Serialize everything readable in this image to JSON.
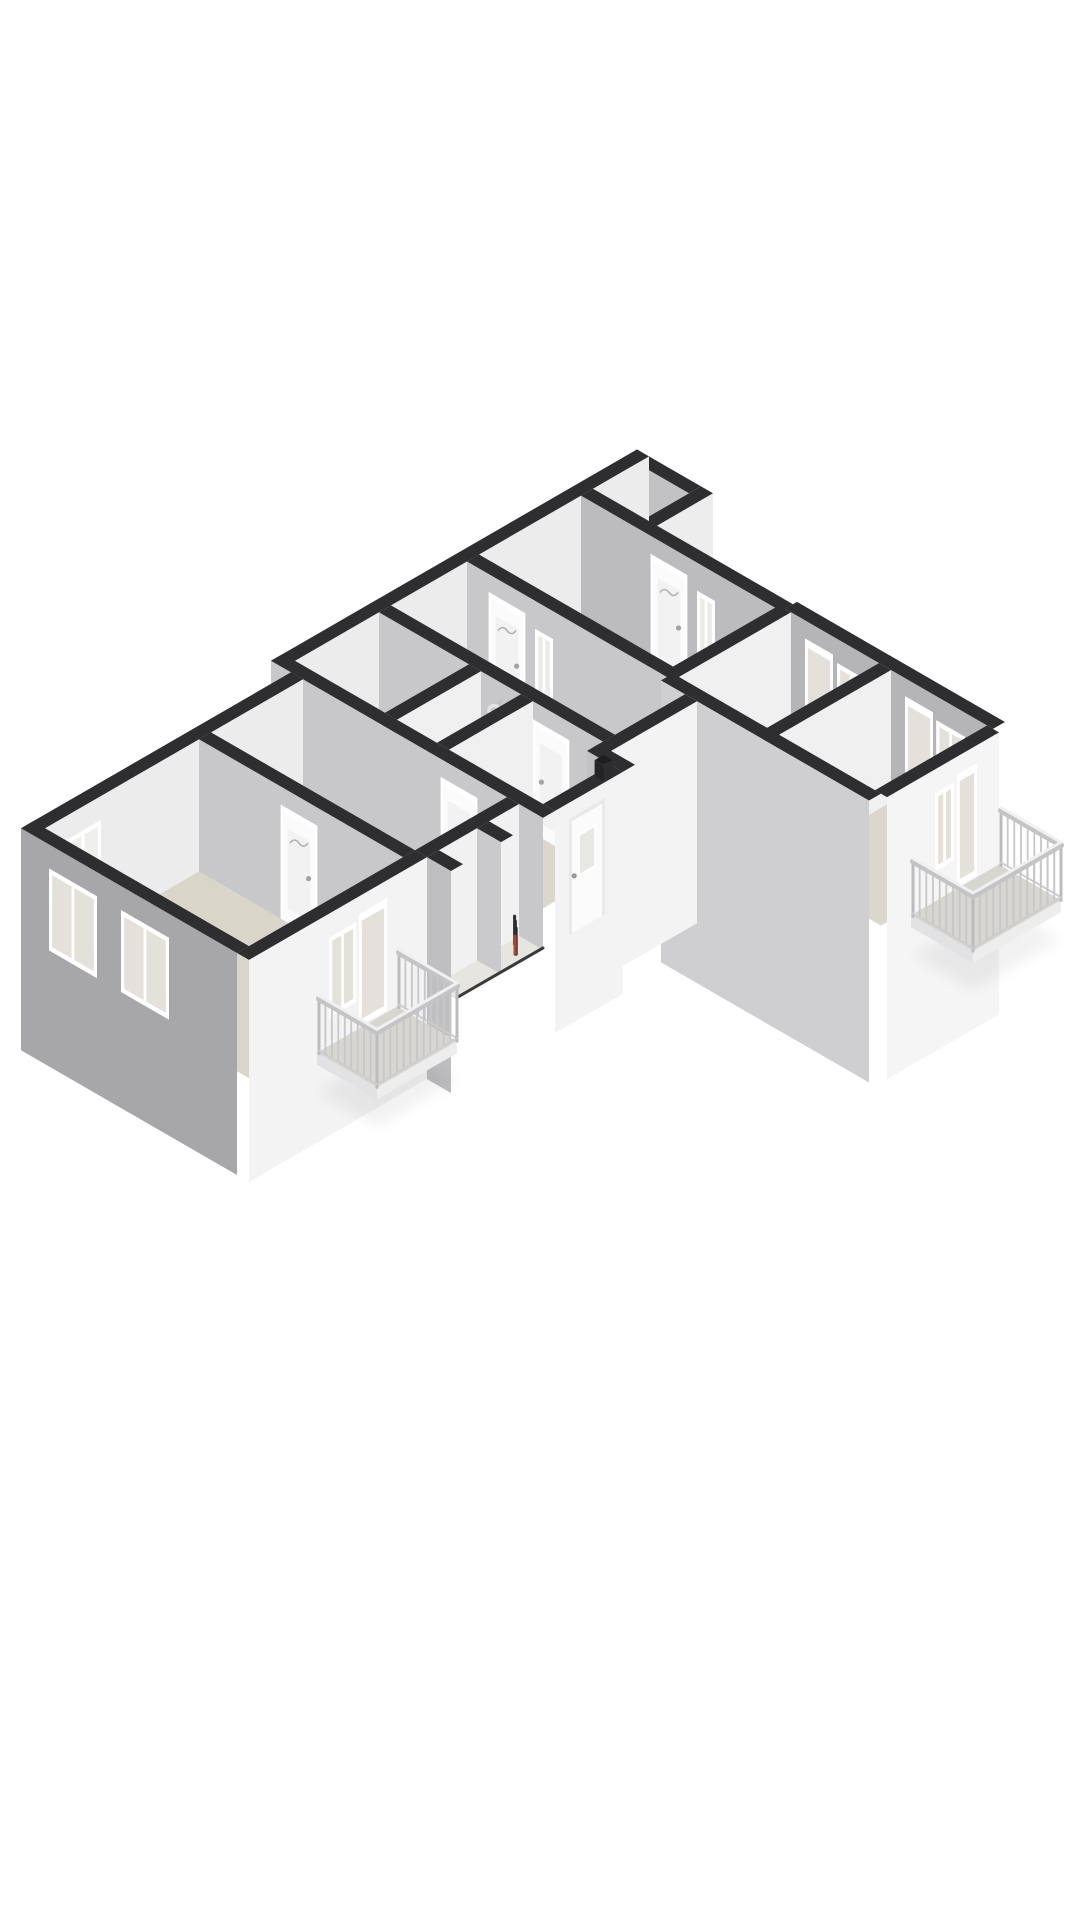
{
  "canvas": {
    "width": 1080,
    "height": 1920
  },
  "scene": {
    "view": "isometric-3d-floor-plan",
    "background": "#ffffff"
  },
  "palette": {
    "background": "#ffffff",
    "wall_cap": "#2e2e30",
    "face_bright": "#f3f3f4",
    "face_light": "#ececed",
    "face_interior_grey": "#c8c8ca",
    "facade_grey": "#a7a7a9",
    "facade_grey_light": "#cfcfd1",
    "facade_inner_grey": "#b5b5b7",
    "floor": "#dbd7cc",
    "floor_bath": "#e0dcd2",
    "floor_shower": "#e2ded5",
    "floor_living": "#d9d5c9",
    "floor_pale": "#e7e5e0",
    "floor_closet": "#ebe9e4",
    "floor_balcony": "#d8d6d0",
    "window_frame": "#ffffff",
    "window_pane": "#e4e1da",
    "pane_cool": "#eceae6",
    "door_leaf": "#fbfbfc",
    "railing_light": "#f0f0f1",
    "railing_mid": "#c7c7c9",
    "fixture_white": "#fbfbfc",
    "basin_grey": "#d8d8d5",
    "meter_dark": "#2e2e30",
    "meter_red": "#b5412f"
  },
  "structure": {
    "rooms": [
      {
        "name": "storage-closet-north"
      },
      {
        "name": "entry-hall"
      },
      {
        "name": "bedroom-northeast"
      },
      {
        "name": "bathroom"
      },
      {
        "name": "shower-room"
      },
      {
        "name": "inner-corridor"
      },
      {
        "name": "hall-south"
      },
      {
        "name": "living-room"
      },
      {
        "name": "bedroom-east-1"
      },
      {
        "name": "bedroom-east-2"
      },
      {
        "name": "storage-cells-gallery"
      }
    ],
    "balconies": [
      {
        "name": "east-balcony",
        "railing": "vertical-slats"
      },
      {
        "name": "southwest-balcony",
        "railing": "vertical-slats"
      }
    ],
    "fixtures": [
      {
        "name": "washbasin"
      },
      {
        "name": "shower-set"
      },
      {
        "name": "meter-cupboard-items"
      },
      {
        "name": "roof-vent-box"
      }
    ],
    "openings": {
      "entry_doors": 2,
      "interior_doors": 5,
      "glazed_balcony_doors": 3,
      "windows": 9
    }
  }
}
